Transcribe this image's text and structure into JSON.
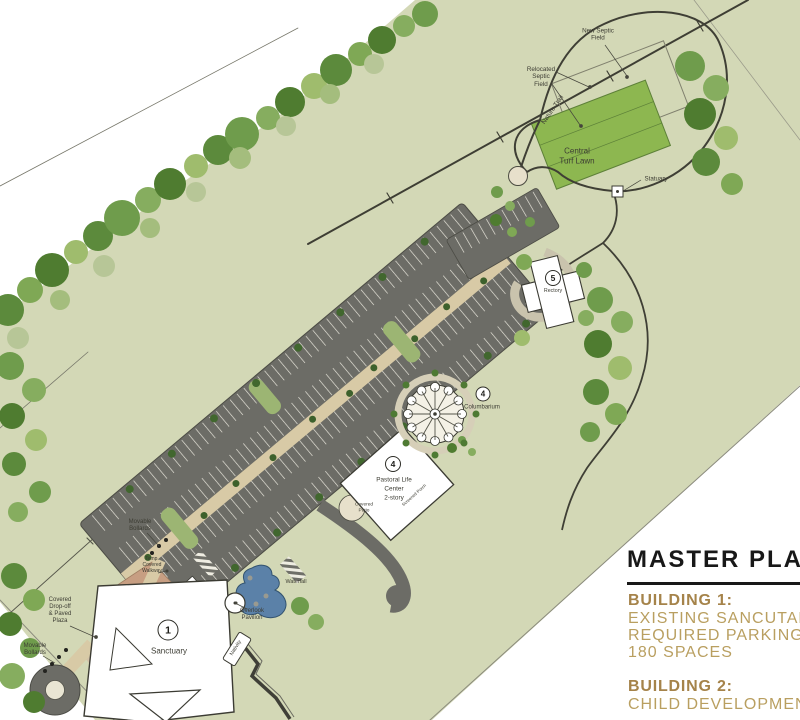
{
  "panel": {
    "title": "MASTER PLAN",
    "building1": {
      "heading": "BUILDING 1:",
      "lines": [
        "EXISTING SANCUTARY",
        "REQUIRED PARKING",
        "180 SPACES"
      ]
    },
    "building2": {
      "heading": "BUILDING 2:",
      "lines": [
        "CHILD DEVELOPMENT"
      ]
    }
  },
  "plan": {
    "labels": {
      "new_septic_field": [
        "New Septic",
        "Field"
      ],
      "relocated_septic_field": [
        "Relocated",
        "Septic",
        "Field"
      ],
      "nature_trail": "Nature Trail",
      "central_turf_lawn": [
        "Central",
        "Turf Lawn"
      ],
      "statuary": "Statuary",
      "waterfall": "Waterfall",
      "overlook_pavilion": [
        "Overlook",
        "Pavilion"
      ],
      "nativity": "Nativity",
      "movable_bollards_upper": [
        "Movable",
        "Bollards"
      ],
      "movable_bollards_lower": [
        "Movable",
        "Bollards"
      ],
      "temp_covered_walkway": [
        "Temp.",
        "Covered",
        "Walkway"
      ],
      "covered_dropoff_plaza": [
        "Covered",
        "Drop-off",
        "& Paved",
        "Plaza"
      ],
      "covered_patio": [
        "Covered",
        "Patio"
      ],
      "screened_porch": "Screened Porch"
    },
    "buildings": {
      "sanctuary": {
        "number": "1",
        "name": "Sanctuary"
      },
      "pastoral_life_center": {
        "number": "4",
        "name_lines": [
          "Pastoral Life",
          "Center",
          "2-story"
        ]
      },
      "columbarium": {
        "number": "4",
        "name": "Columbarium"
      },
      "rectory": {
        "number": "5",
        "name": "Rectory"
      }
    },
    "colors": {
      "site_green": "#d3d8b6",
      "turf_green": "#8db750",
      "asphalt": "#6c6c66",
      "walkway_tan": "#d8caa6",
      "plaza_terracotta": "#c79e82",
      "pond_blue": "#5b81a8",
      "title_black": "#181818",
      "gold_heading": "#a5834a",
      "gold_body": "#b99f60"
    }
  }
}
